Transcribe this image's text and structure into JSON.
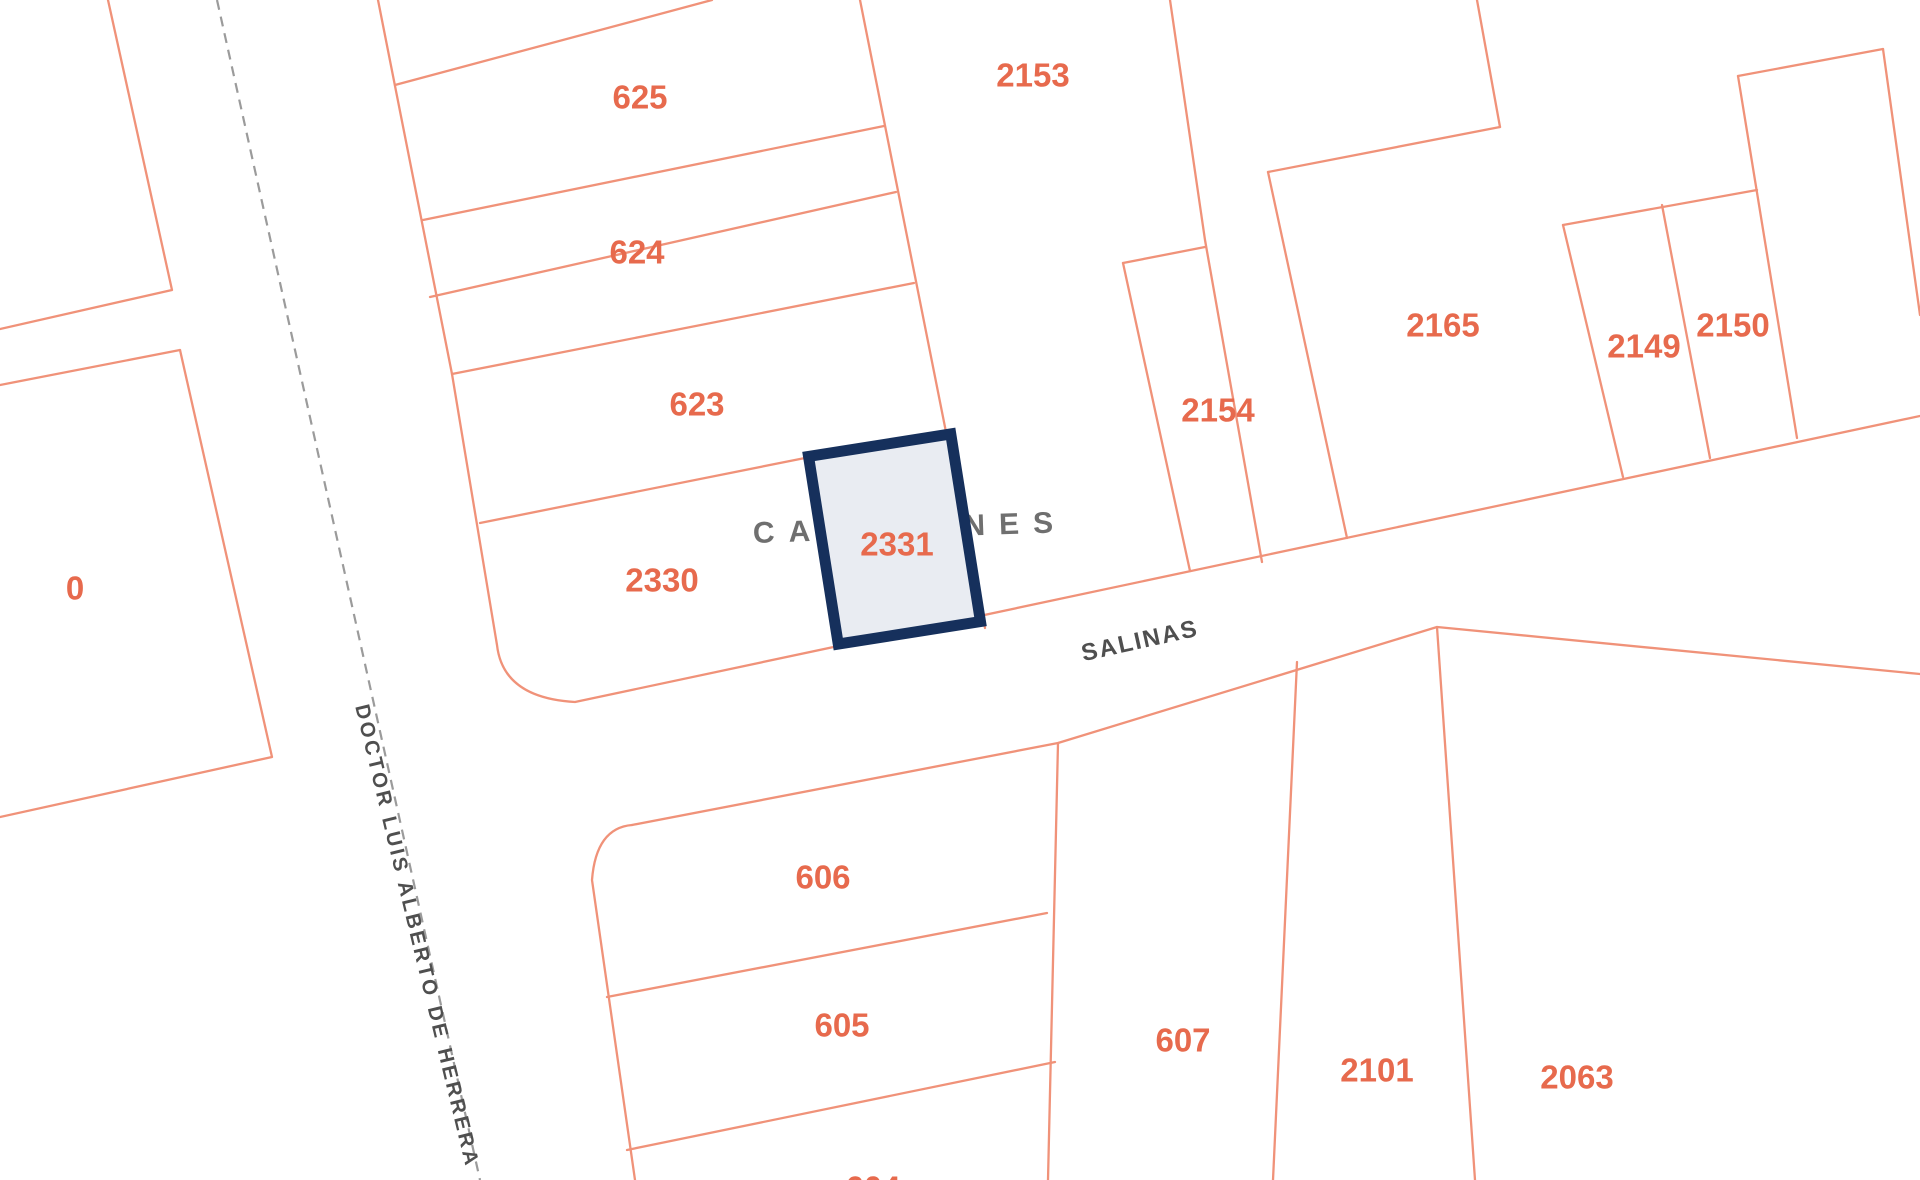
{
  "map": {
    "parcel_labels": {
      "p0": "0",
      "p604": "604",
      "p605": "605",
      "p606": "606",
      "p607": "607",
      "p623": "623",
      "p624": "624",
      "p625": "625",
      "p2063": "2063",
      "p2101": "2101",
      "p2149": "2149",
      "p2150": "2150",
      "p2153": "2153",
      "p2154": "2154",
      "p2165": "2165",
      "p2330": "2330"
    },
    "selected_parcel": {
      "label": "2331",
      "fill": "#E9ECF2",
      "border": "#16305C"
    },
    "streets": {
      "canelones": "CANELONES",
      "salinas": "SALINAS",
      "herrera": "DOCTOR LUIS ALBERTO DE HERRERA"
    },
    "colors": {
      "boundary": "#F09279",
      "parcel_label": "#E76A4D",
      "street_label": "#6F6F6F",
      "street_label_dark": "#4F4F4F",
      "centerline": "#9B9B9B",
      "background": "#FFFFFF"
    }
  }
}
